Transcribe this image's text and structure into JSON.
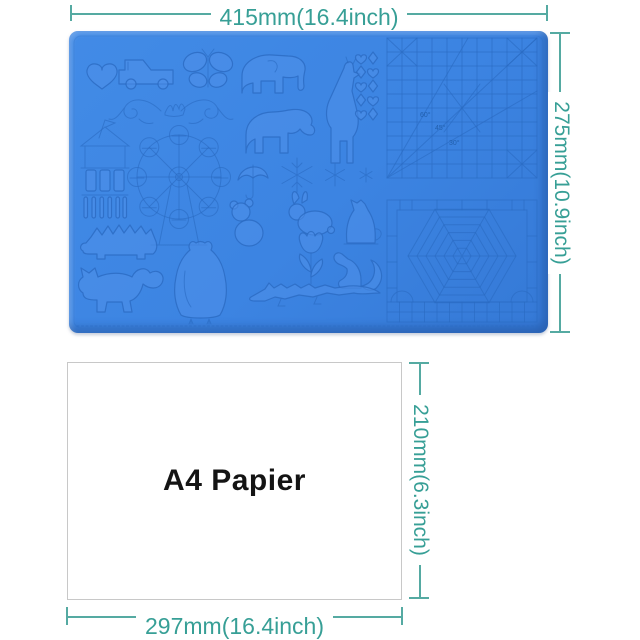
{
  "mat": {
    "width_label": "415mm(16.4inch)",
    "height_label": "275mm(10.9inch)",
    "surface_color": "#3C83E1",
    "engraving_line_color": "#2A6AC2",
    "angle_labels": {
      "deg60": "60°",
      "deg45": "45°",
      "deg30": "30°"
    },
    "shapes": [
      "heart",
      "pickup-truck",
      "butterfly",
      "elephant",
      "giraffe",
      "hearts-and-diamonds",
      "floral-flourish",
      "carousel-chimes",
      "ferris-wheel",
      "hippo",
      "umbrella",
      "snowflake-large",
      "snowflake-medium",
      "snowflake-small",
      "teddy-bear",
      "rabbit",
      "cat",
      "tulip",
      "squirrel",
      "hedgehog",
      "fox",
      "owl",
      "crocodile",
      "angle-grid",
      "spider-web",
      "ruler-scale"
    ]
  },
  "paper": {
    "label": "A4 Papier",
    "width_label": "297mm(16.4inch)",
    "height_label": "210mm(6.3inch)",
    "border_color": "#c8c8c8"
  },
  "annotation_color": "#379F96"
}
